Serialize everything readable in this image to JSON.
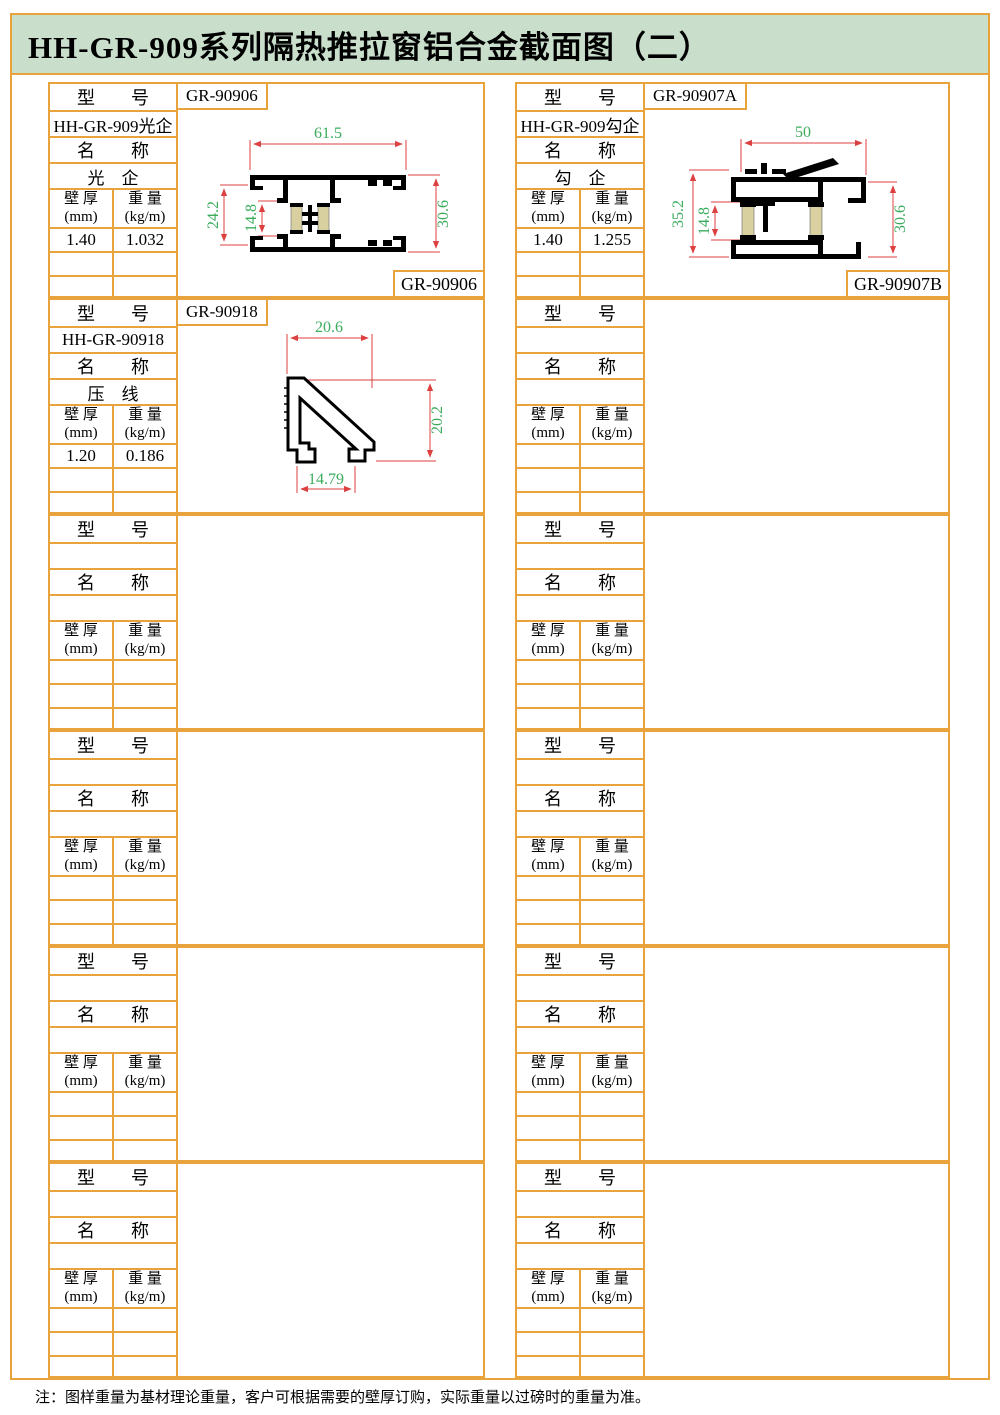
{
  "page": {
    "title": "HH-GR-909系列隔热推拉窗铝合金截面图（二）",
    "note": "注：图样重量为基材理论重量，客户可根据需要的壁厚订购，实际重量以过磅时的重量为准。"
  },
  "labels": {
    "model": "型　　号",
    "name": "名　　称",
    "thickness_l1": "壁 厚",
    "thickness_l2": "(mm)",
    "weight_l1": "重 量",
    "weight_l2": "(kg/m)"
  },
  "colors": {
    "border_orange": "#e8a33c",
    "title_background": "#c9dfcc",
    "dimension_line_red": "#dd4040",
    "dimension_text_green": "#3aac5c",
    "thermal_strip_tan": "#d9d0a0"
  },
  "blocks": [
    {
      "position": "row1-left",
      "model_code": "GR-90906",
      "model_value": "HH-GR-909光企",
      "name_value": "光　企",
      "thickness": "1.40",
      "weight": "1.032",
      "corner_code": "GR-90906",
      "dims": {
        "top": "61.5",
        "left": "24.2",
        "mid": "14.8",
        "right": "30.6"
      }
    },
    {
      "position": "row1-right",
      "model_code": "GR-90907A",
      "model_value": "HH-GR-909勾企",
      "name_value": "勾　企",
      "thickness": "1.40",
      "weight": "1.255",
      "corner_code": "GR-90907B",
      "dims": {
        "top": "50",
        "left": "35.2",
        "mid": "14.8",
        "right": "30.6"
      }
    },
    {
      "position": "row2-left",
      "model_code": "GR-90918",
      "model_value": "HH-GR-90918",
      "name_value": "压　线",
      "thickness": "1.20",
      "weight": "0.186",
      "dims": {
        "top": "20.6",
        "right": "20.2",
        "bottom": "14.79"
      }
    }
  ]
}
